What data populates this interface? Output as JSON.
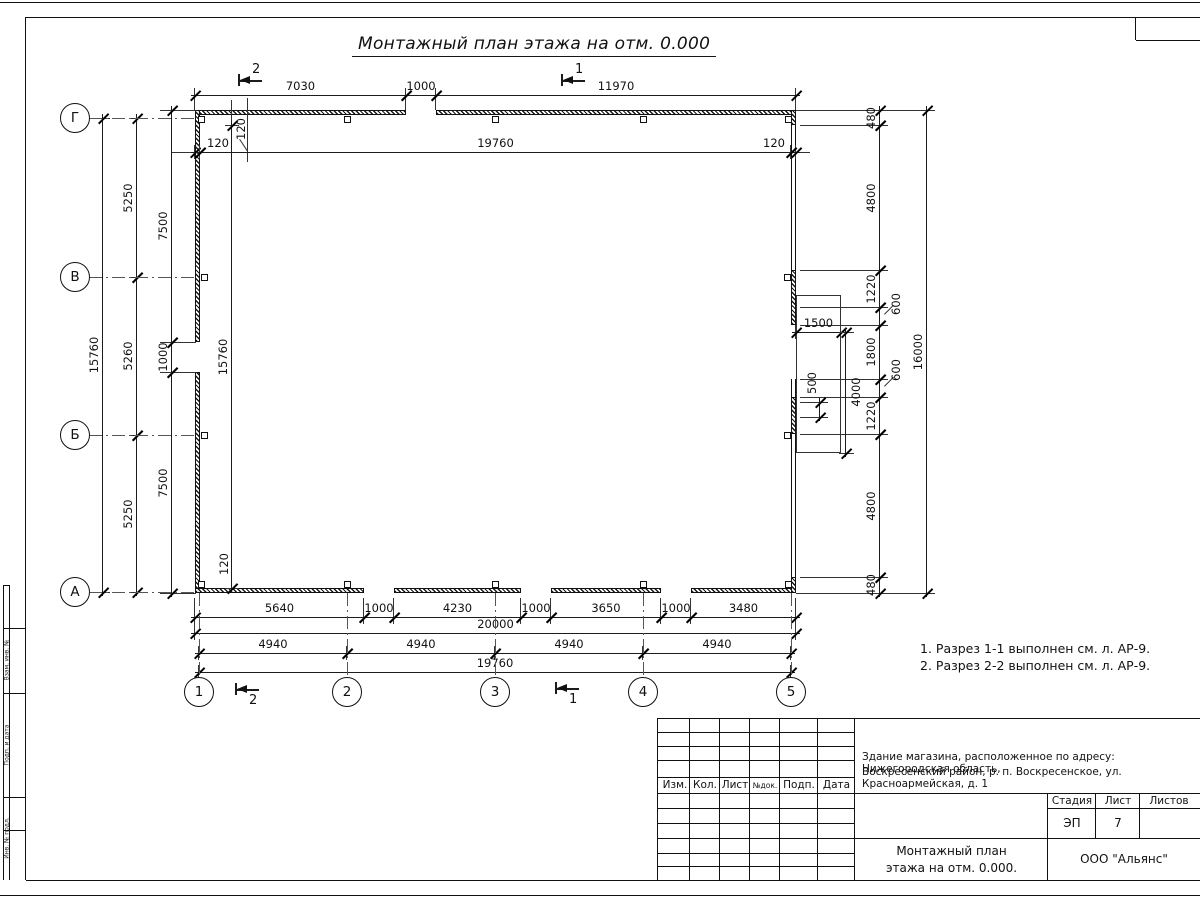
{
  "sheet": {
    "title": "Монтажный план этажа на отм. 0.000",
    "notes": [
      "1. Разрез 1-1 выполнен см. л. АР-9.",
      "2. Разрез 2-2 выполнен см. л. АР-9."
    ]
  },
  "title_block": {
    "rev_headers": [
      "Изм.",
      "Кол.",
      "Лист",
      "№док.",
      "Подп.",
      "Дата"
    ],
    "project_line1": "Здание магазина, расположенное по адресу: Нижегородская область,",
    "project_line2": "Воскресенский район, р. п. Воскресенское, ул. Красноармейская, д. 1",
    "stage_label": "Стадия",
    "sheet_label": "Лист",
    "sheets_label": "Листов",
    "stage_value": "ЭП",
    "sheet_value": "7",
    "sheets_value": "",
    "doc_title_line1": "Монтажный план",
    "doc_title_line2": "этажа на отм. 0.000.",
    "company": "ООО \"Альянс\""
  },
  "side_stamp": [
    {
      "t": "Взам. инв. №",
      "y": 660
    },
    {
      "t": "Подп. и дата",
      "y": 745
    },
    {
      "t": "Инв. № подл.",
      "y": 838
    }
  ],
  "drawing": {
    "walls": [
      {
        "x": 195,
        "y": 110,
        "w": 211,
        "h": 5,
        "k": "h"
      },
      {
        "x": 436,
        "y": 110,
        "w": 360,
        "h": 5,
        "k": "h"
      },
      {
        "x": 195,
        "y": 110,
        "w": 5,
        "h": 232,
        "k": "h"
      },
      {
        "x": 195,
        "y": 372,
        "w": 5,
        "h": 221,
        "k": "h"
      },
      {
        "x": 195,
        "y": 588,
        "w": 169,
        "h": 5,
        "k": "h"
      },
      {
        "x": 394,
        "y": 588,
        "w": 127,
        "h": 5,
        "k": "h"
      },
      {
        "x": 551,
        "y": 588,
        "w": 110,
        "h": 5,
        "k": "h"
      },
      {
        "x": 691,
        "y": 588,
        "w": 105,
        "h": 5,
        "k": "h"
      },
      {
        "x": 791,
        "y": 110,
        "w": 5,
        "h": 15,
        "k": "h"
      },
      {
        "x": 791,
        "y": 125,
        "w": 5,
        "h": 145,
        "k": "t"
      },
      {
        "x": 791,
        "y": 270,
        "w": 5,
        "h": 55,
        "k": "h"
      },
      {
        "x": 791,
        "y": 379,
        "w": 5,
        "h": 18,
        "k": "t"
      },
      {
        "x": 791,
        "y": 397,
        "w": 5,
        "h": 37,
        "k": "h"
      },
      {
        "x": 791,
        "y": 434,
        "w": 5,
        "h": 143,
        "k": "t"
      },
      {
        "x": 791,
        "y": 577,
        "w": 5,
        "h": 16,
        "k": "h"
      }
    ],
    "porch": {
      "x": 796,
      "y": 295,
      "w": 45,
      "h": 158
    },
    "columns": [
      {
        "x": 198,
        "y": 116
      },
      {
        "x": 344,
        "y": 116
      },
      {
        "x": 492,
        "y": 116
      },
      {
        "x": 640,
        "y": 116
      },
      {
        "x": 785,
        "y": 116
      },
      {
        "x": 201,
        "y": 274
      },
      {
        "x": 784,
        "y": 274
      },
      {
        "x": 201,
        "y": 432
      },
      {
        "x": 784,
        "y": 432
      },
      {
        "x": 198,
        "y": 581
      },
      {
        "x": 344,
        "y": 581
      },
      {
        "x": 492,
        "y": 581
      },
      {
        "x": 640,
        "y": 581
      },
      {
        "x": 785,
        "y": 581
      }
    ],
    "dims_h": [
      {
        "t": "7030",
        "x1": 195,
        "x2": 406,
        "y": 95
      },
      {
        "t": "1000",
        "x1": 406,
        "x2": 436,
        "y": 95
      },
      {
        "t": "11970",
        "x1": 436,
        "x2": 796,
        "y": 95
      },
      {
        "t": "120",
        "x1": 195,
        "x2": 200,
        "y": 152,
        "lx": 218
      },
      {
        "t": "19760",
        "x1": 200,
        "x2": 791,
        "y": 152
      },
      {
        "t": "120",
        "x1": 791,
        "x2": 796,
        "y": 152,
        "lx": 774
      },
      {
        "t": "5640",
        "x1": 195,
        "x2": 364,
        "y": 617
      },
      {
        "t": "1000",
        "x1": 364,
        "x2": 394,
        "y": 617
      },
      {
        "t": "4230",
        "x1": 394,
        "x2": 521,
        "y": 617
      },
      {
        "t": "1000",
        "x1": 521,
        "x2": 551,
        "y": 617
      },
      {
        "t": "3650",
        "x1": 551,
        "x2": 661,
        "y": 617
      },
      {
        "t": "1000",
        "x1": 661,
        "x2": 691,
        "y": 617
      },
      {
        "t": "3480",
        "x1": 691,
        "x2": 796,
        "y": 617
      },
      {
        "t": "20000",
        "x1": 195,
        "x2": 796,
        "y": 633
      },
      {
        "t": "4940",
        "x1": 199,
        "x2": 347,
        "y": 653
      },
      {
        "t": "4940",
        "x1": 347,
        "x2": 495,
        "y": 653
      },
      {
        "t": "4940",
        "x1": 495,
        "x2": 643,
        "y": 653
      },
      {
        "t": "4940",
        "x1": 643,
        "x2": 791,
        "y": 653
      },
      {
        "t": "19760",
        "x1": 199,
        "x2": 791,
        "y": 672
      },
      {
        "t": "1500",
        "x1": 796,
        "x2": 841,
        "y": 332
      }
    ],
    "dims_v": [
      {
        "t": "15760",
        "y1": 118,
        "y2": 592,
        "x": 103
      },
      {
        "t": "5250",
        "y1": 118,
        "y2": 277,
        "x": 137
      },
      {
        "t": "5260",
        "y1": 277,
        "y2": 435,
        "x": 137
      },
      {
        "t": "5250",
        "y1": 435,
        "y2": 592,
        "x": 137
      },
      {
        "t": "7500",
        "y1": 110,
        "y2": 342,
        "x": 172
      },
      {
        "t": "1000",
        "y1": 342,
        "y2": 372,
        "x": 172
      },
      {
        "t": "7500",
        "y1": 372,
        "y2": 593,
        "x": 172
      },
      {
        "t": "15760",
        "y1": 125,
        "y2": 588,
        "x": 232
      },
      {
        "t": "480",
        "y1": 110,
        "y2": 125,
        "x": 880
      },
      {
        "t": "4800",
        "y1": 125,
        "y2": 270,
        "x": 880
      },
      {
        "t": "1220",
        "y1": 270,
        "y2": 307,
        "x": 880
      },
      {
        "t": "600",
        "y1": 307,
        "y2": 325,
        "x": 880,
        "lx": 896,
        "ly": 304
      },
      {
        "t": "1800",
        "y1": 325,
        "y2": 379,
        "x": 880
      },
      {
        "t": "600",
        "y1": 379,
        "y2": 397,
        "x": 880,
        "lx": 896,
        "ly": 370
      },
      {
        "t": "1220",
        "y1": 397,
        "y2": 434,
        "x": 880
      },
      {
        "t": "4800",
        "y1": 434,
        "y2": 577,
        "x": 880
      },
      {
        "t": "480",
        "y1": 577,
        "y2": 593,
        "x": 880
      },
      {
        "t": "16000",
        "y1": 110,
        "y2": 593,
        "x": 927
      },
      {
        "t": "4000",
        "y1": 332,
        "y2": 453,
        "x": 846,
        "lx": 856,
        "ly": 392
      },
      {
        "t": "500",
        "y1": 402,
        "y2": 417,
        "x": 820,
        "lx": 812,
        "ly": 383
      }
    ],
    "free_labels": [
      {
        "t": "120",
        "x": 241,
        "y": 129
      },
      {
        "t": "120",
        "x": 224,
        "y": 564
      }
    ],
    "xlines": [
      [
        195,
        88,
        195,
        110
      ],
      [
        406,
        88,
        406,
        110
      ],
      [
        436,
        88,
        436,
        110
      ],
      [
        796,
        88,
        796,
        110
      ],
      [
        172,
        152,
        195,
        152
      ],
      [
        796,
        152,
        810,
        152
      ],
      [
        160,
        110,
        196,
        110
      ],
      [
        160,
        342,
        196,
        342
      ],
      [
        160,
        372,
        196,
        372
      ],
      [
        160,
        593,
        196,
        593
      ],
      [
        232,
        100,
        232,
        125
      ],
      [
        248,
        98,
        248,
        162
      ],
      [
        240,
        139,
        248,
        151
      ],
      [
        796,
        110,
        935,
        110
      ],
      [
        796,
        593,
        935,
        593
      ],
      [
        800,
        125,
        888,
        125
      ],
      [
        800,
        270,
        888,
        270
      ],
      [
        800,
        307,
        888,
        307
      ],
      [
        800,
        325,
        888,
        325
      ],
      [
        800,
        379,
        888,
        379
      ],
      [
        800,
        397,
        888,
        397
      ],
      [
        800,
        434,
        888,
        434
      ],
      [
        800,
        577,
        888,
        577
      ],
      [
        884,
        314,
        893,
        305
      ],
      [
        884,
        386,
        893,
        377
      ],
      [
        841,
        332,
        854,
        332
      ],
      [
        841,
        453,
        854,
        453
      ],
      [
        800,
        402,
        828,
        402
      ],
      [
        800,
        417,
        828,
        417
      ],
      [
        195,
        598,
        195,
        640
      ],
      [
        796,
        598,
        796,
        640
      ],
      [
        364,
        598,
        364,
        622
      ],
      [
        394,
        598,
        394,
        622
      ],
      [
        521,
        598,
        521,
        622
      ],
      [
        551,
        598,
        551,
        622
      ],
      [
        661,
        598,
        661,
        622
      ],
      [
        691,
        598,
        691,
        622
      ]
    ],
    "axis_rows": [
      {
        "l": "Г",
        "y": 118
      },
      {
        "l": "В",
        "y": 277
      },
      {
        "l": "Б",
        "y": 435
      },
      {
        "l": "А",
        "y": 592
      }
    ],
    "axis_cols": [
      {
        "l": "1",
        "x": 199
      },
      {
        "l": "2",
        "x": 347
      },
      {
        "l": "3",
        "x": 495
      },
      {
        "l": "4",
        "x": 643
      },
      {
        "l": "5",
        "x": 791
      }
    ],
    "sections": [
      {
        "l": "2",
        "x": 240,
        "y": 80,
        "p": "t"
      },
      {
        "l": "1",
        "x": 563,
        "y": 80,
        "p": "t"
      },
      {
        "l": "2",
        "x": 237,
        "y": 689,
        "p": "b"
      },
      {
        "l": "1",
        "x": 557,
        "y": 688,
        "p": "b"
      }
    ],
    "frame_lines": [
      [
        0,
        2,
        1200,
        2
      ],
      [
        26,
        17,
        1200,
        17
      ],
      [
        26,
        17,
        26,
        880
      ],
      [
        26,
        880,
        1200,
        880
      ],
      [
        0,
        895,
        1200,
        895
      ],
      [
        1136,
        17,
        1136,
        40
      ],
      [
        1136,
        40,
        1200,
        40
      ],
      [
        4,
        585,
        4,
        880
      ],
      [
        10,
        585,
        10,
        880
      ],
      [
        4,
        585,
        10,
        585
      ],
      [
        4,
        628,
        26,
        628
      ],
      [
        4,
        693,
        26,
        693
      ],
      [
        4,
        797,
        26,
        797
      ],
      [
        4,
        830,
        26,
        830
      ]
    ],
    "tb_lines": [
      [
        658,
        718,
        1200,
        718
      ],
      [
        658,
        732,
        855,
        732
      ],
      [
        658,
        746,
        855,
        746
      ],
      [
        658,
        760,
        855,
        760
      ],
      [
        658,
        777,
        855,
        777
      ],
      [
        658,
        793,
        1200,
        793
      ],
      [
        658,
        808,
        855,
        808
      ],
      [
        1048,
        808,
        1200,
        808
      ],
      [
        658,
        823,
        855,
        823
      ],
      [
        658,
        838,
        1200,
        838
      ],
      [
        658,
        853,
        855,
        853
      ],
      [
        658,
        866,
        855,
        866
      ],
      [
        658,
        718,
        658,
        880
      ],
      [
        690,
        718,
        690,
        880
      ],
      [
        720,
        718,
        720,
        880
      ],
      [
        750,
        718,
        750,
        880
      ],
      [
        780,
        718,
        780,
        880
      ],
      [
        818,
        718,
        818,
        880
      ],
      [
        855,
        718,
        855,
        880
      ],
      [
        1048,
        793,
        1048,
        880
      ],
      [
        1096,
        793,
        1096,
        838
      ],
      [
        1140,
        793,
        1140,
        838
      ]
    ]
  }
}
